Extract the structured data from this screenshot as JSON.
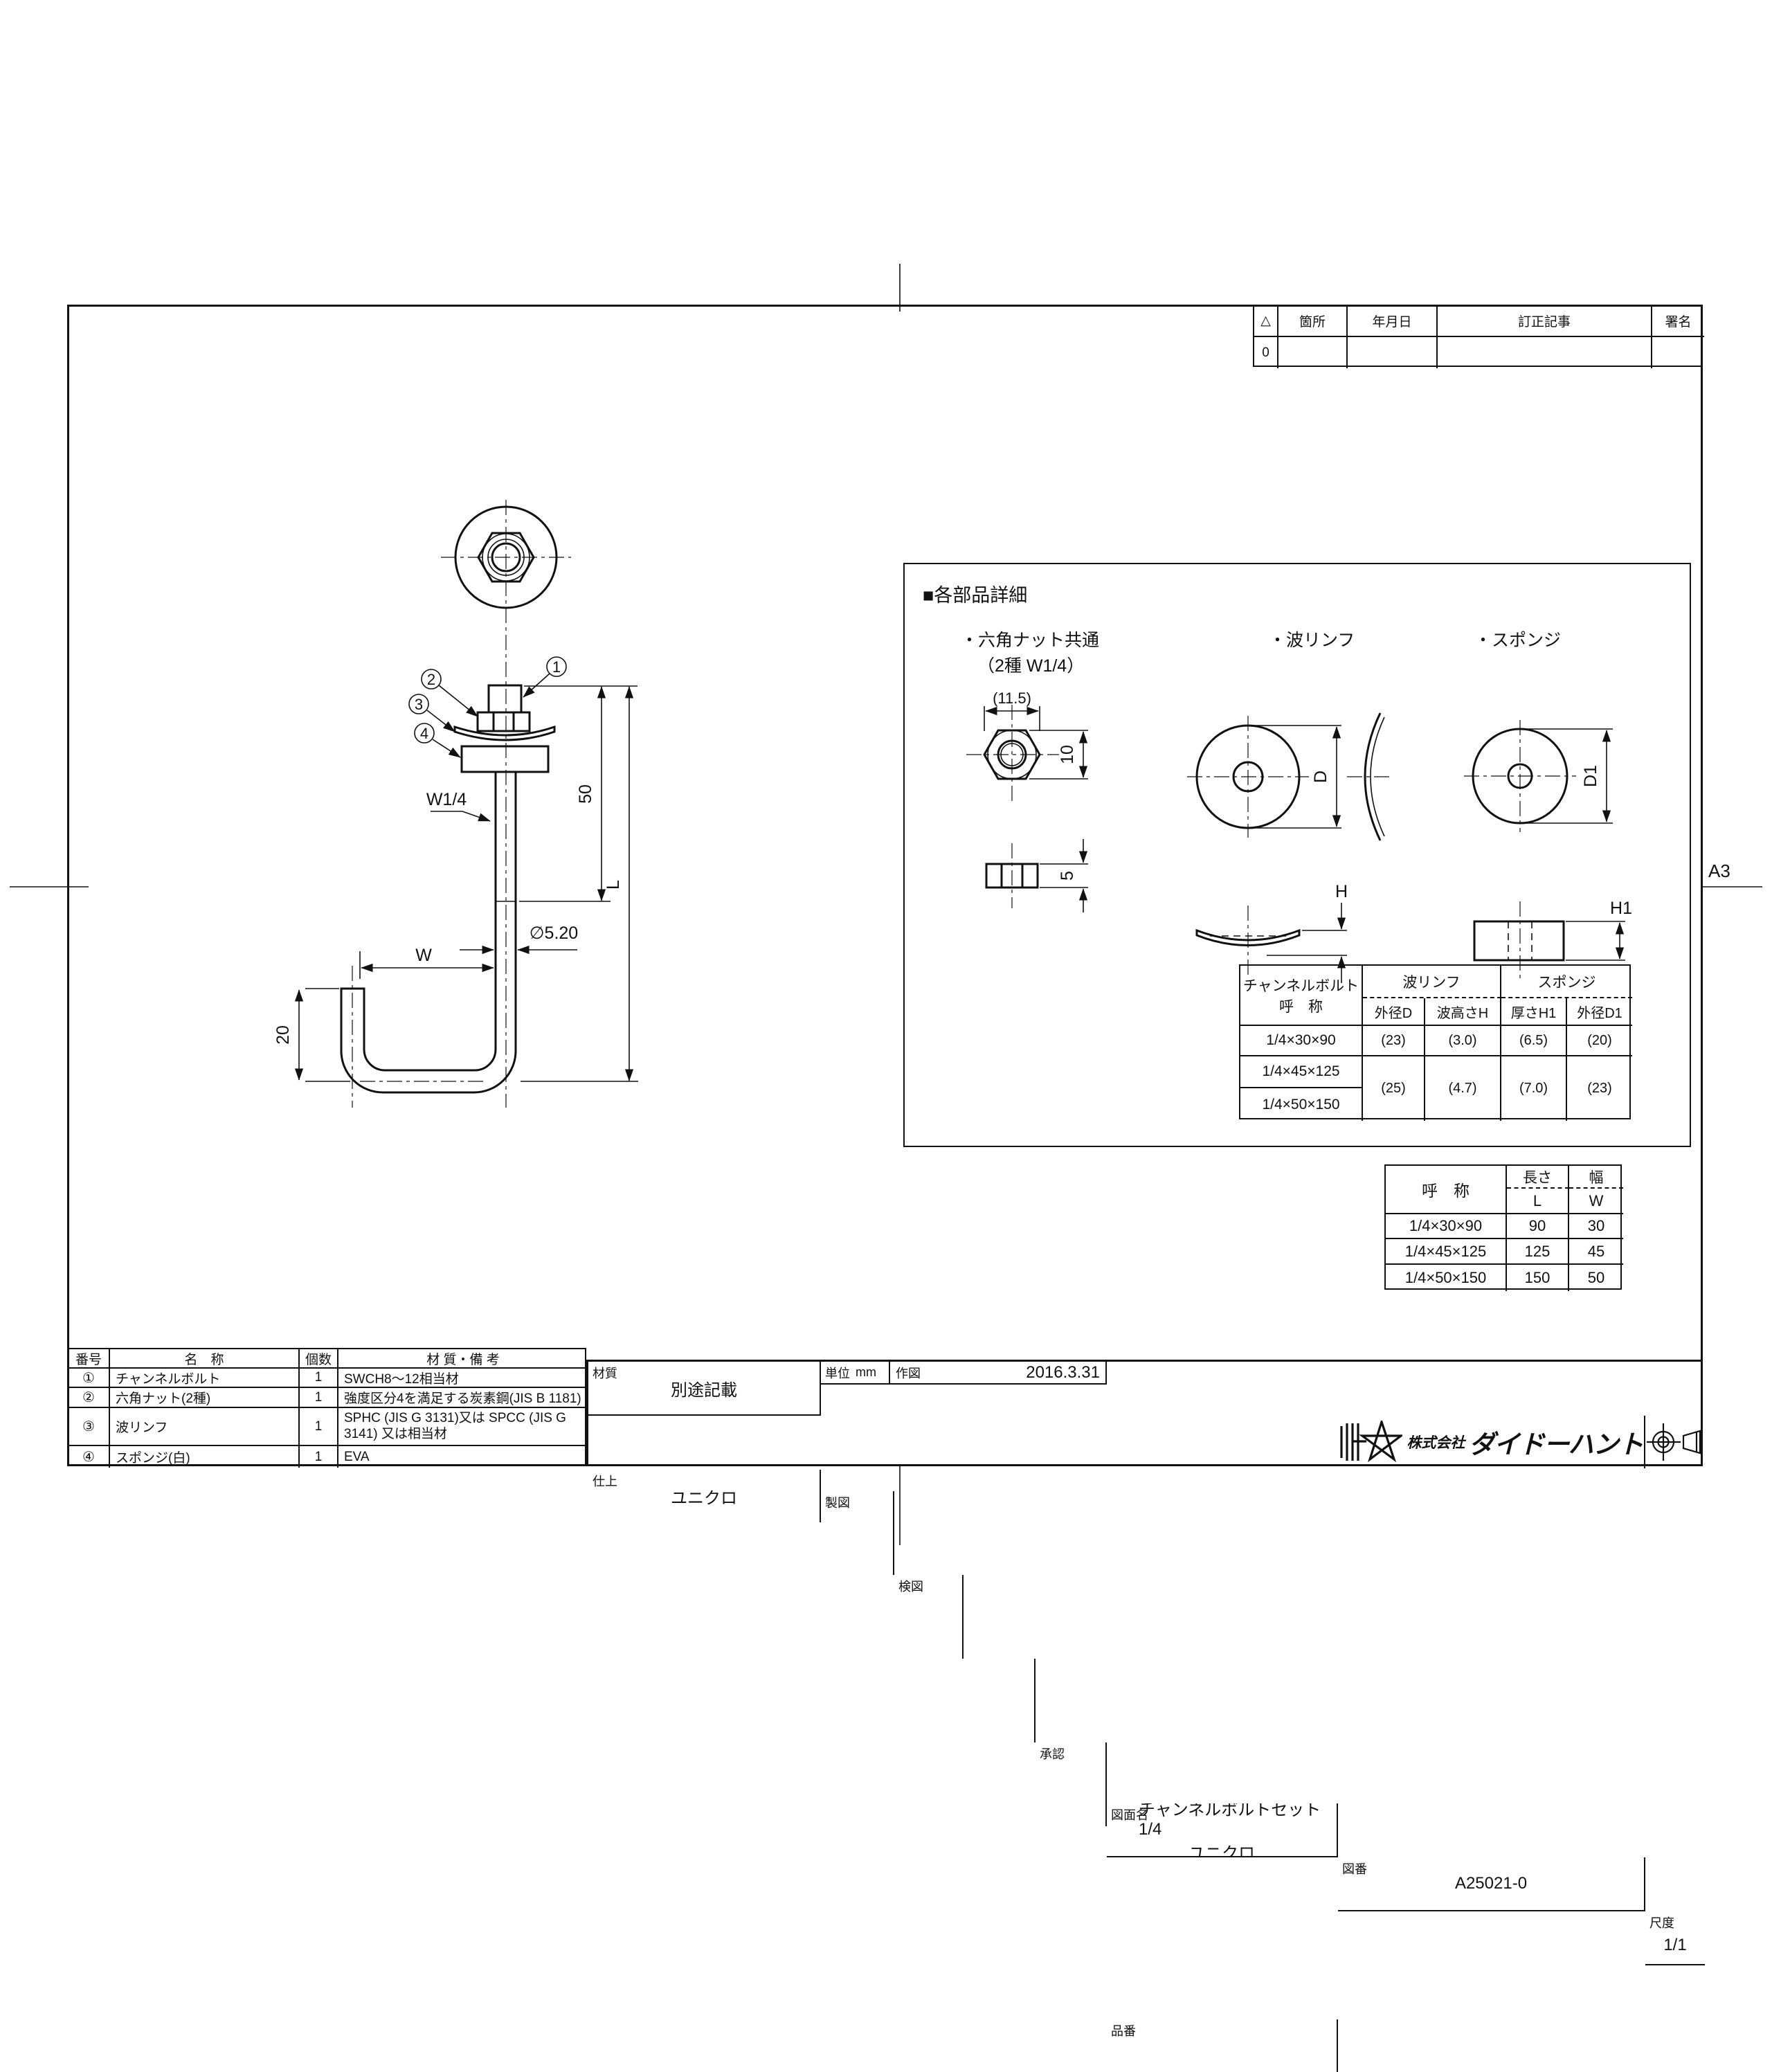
{
  "frame": {
    "size_label": "A3"
  },
  "revision_table": {
    "headers": [
      "△",
      "箇所",
      "年月日",
      "訂正記事",
      "署名"
    ],
    "row": [
      "0",
      "",
      "",
      "",
      ""
    ]
  },
  "main_drawing": {
    "balloons": [
      "1",
      "2",
      "3",
      "4"
    ],
    "thread_label": "W1/4",
    "dim_50": "50",
    "dim_L": "L",
    "dim_dia": "∅5.20",
    "dim_W": "W",
    "dim_20": "20"
  },
  "detail_panel": {
    "title": "■各部品詳細",
    "nut_label": "・六角ナット共通",
    "nut_sublabel": "（2種 W1/4）",
    "washer_label": "・波リンフ",
    "sponge_label": "・スポンジ",
    "nut_dim_flats": "(11.5)",
    "nut_dim_height": "10",
    "nut_dim_thickness": "5",
    "washer_dim_d": "D",
    "washer_dim_h": "H",
    "sponge_dim_d": "D1",
    "sponge_dim_h": "H1",
    "spec_table": {
      "name_header_l1": "チャンネルボルト",
      "name_header_l2": "呼　称",
      "group_washer": "波リンフ",
      "group_sponge": "スポンジ",
      "sub_d": "外径D",
      "sub_h": "波高さH",
      "sub_h1": "厚さH1",
      "sub_d1": "外径D1",
      "r1_name": "1/4×30×90",
      "r1_d": "(23)",
      "r1_h": "(3.0)",
      "r1_h1": "(6.5)",
      "r1_d1": "(20)",
      "r2_name": "1/4×45×125",
      "r3_name": "1/4×50×150",
      "m_d": "(25)",
      "m_h": "(4.7)",
      "m_h1": "(7.0)",
      "m_d1": "(23)"
    }
  },
  "size_table": {
    "name_header": "呼　称",
    "len_header": "長さ",
    "len_sub": "L",
    "wid_header": "幅",
    "wid_sub": "W",
    "rows": [
      {
        "name": "1/4×30×90",
        "l": "90",
        "w": "30"
      },
      {
        "name": "1/4×45×125",
        "l": "125",
        "w": "45"
      },
      {
        "name": "1/4×50×150",
        "l": "150",
        "w": "50"
      }
    ]
  },
  "parts_table": {
    "headers": {
      "no": "番号",
      "name": "名　称",
      "qty": "個数",
      "material": "材 質・備 考"
    },
    "rows": [
      {
        "no": "①",
        "name": "チャンネルボルト",
        "qty": "1",
        "material": "SWCH8～12相当材"
      },
      {
        "no": "②",
        "name": "六角ナット(2種)",
        "qty": "1",
        "material": "強度区分4を満足する炭素鋼(JIS B 1181)"
      },
      {
        "no": "③",
        "name": "波リンフ",
        "qty": "1",
        "material": "SPHC (JIS G 3131)又は SPCC (JIS G 3141) 又は相当材"
      },
      {
        "no": "④",
        "name": "スポンジ(白)",
        "qty": "1",
        "material": "EVA"
      }
    ]
  },
  "title_block": {
    "material_label": "材質",
    "material_value": "別途記載",
    "finish_label": "仕上",
    "finish_value": "ユニクロ",
    "unit_label": "単位",
    "unit_value": "mm",
    "drawn_label": "作図",
    "drawn_date": "2016.3.31",
    "draft_label": "製図",
    "check_label": "検図",
    "approve_label": "承認",
    "name_label": "図面名",
    "name_line1": "チャンネルボルトセット 1/4",
    "name_line2": "ユニクロ",
    "number_label": "図番",
    "number_value": "A25021-0",
    "scale_label": "尺度",
    "scale_value": "1/1",
    "item_label": "品番",
    "company_prefix": "株式会社",
    "company_name": "ダイドーハント"
  }
}
